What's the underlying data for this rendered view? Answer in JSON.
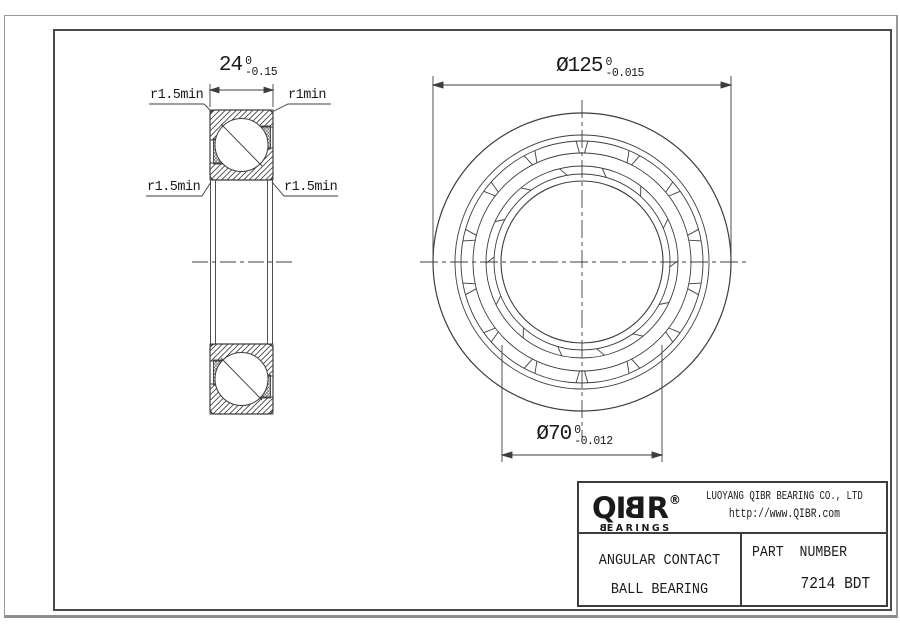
{
  "section_view": {
    "width_dim": {
      "value": "24",
      "tol_upper": "0",
      "tol_lower": "-0.15"
    },
    "radius_labels": {
      "top_left": "r1.5min",
      "top_right": "r1min",
      "mid_left": "r1.5min",
      "mid_right": "r1.5min"
    }
  },
  "front_view": {
    "outer_dia_dim": {
      "value": "Ø125",
      "tol_upper": "0",
      "tol_lower": "-0.015"
    },
    "bore_dia_dim": {
      "value": "Ø70",
      "tol_upper": "0",
      "tol_lower": "-0.012"
    }
  },
  "title_block": {
    "logo": {
      "prefix": "QI",
      "mirrored_letter": "B",
      "suffix": "R",
      "registered_mark": "®",
      "subtitle_mirrored": "B",
      "subtitle_rest": "EARINGS"
    },
    "company_name": "LUOYANG QIBR BEARING CO., LTD",
    "website": "http://www.QIBR.com",
    "product_line1": "ANGULAR CONTACT",
    "product_line2": "BALL BEARING",
    "part_label": "PART  NUMBER",
    "part_number": "7214 BDT"
  },
  "colors": {
    "line": "#3d3d3d",
    "text": "#1a1a1a",
    "frame": "#4a4a4a",
    "outer_border": "#9a9a9a"
  }
}
